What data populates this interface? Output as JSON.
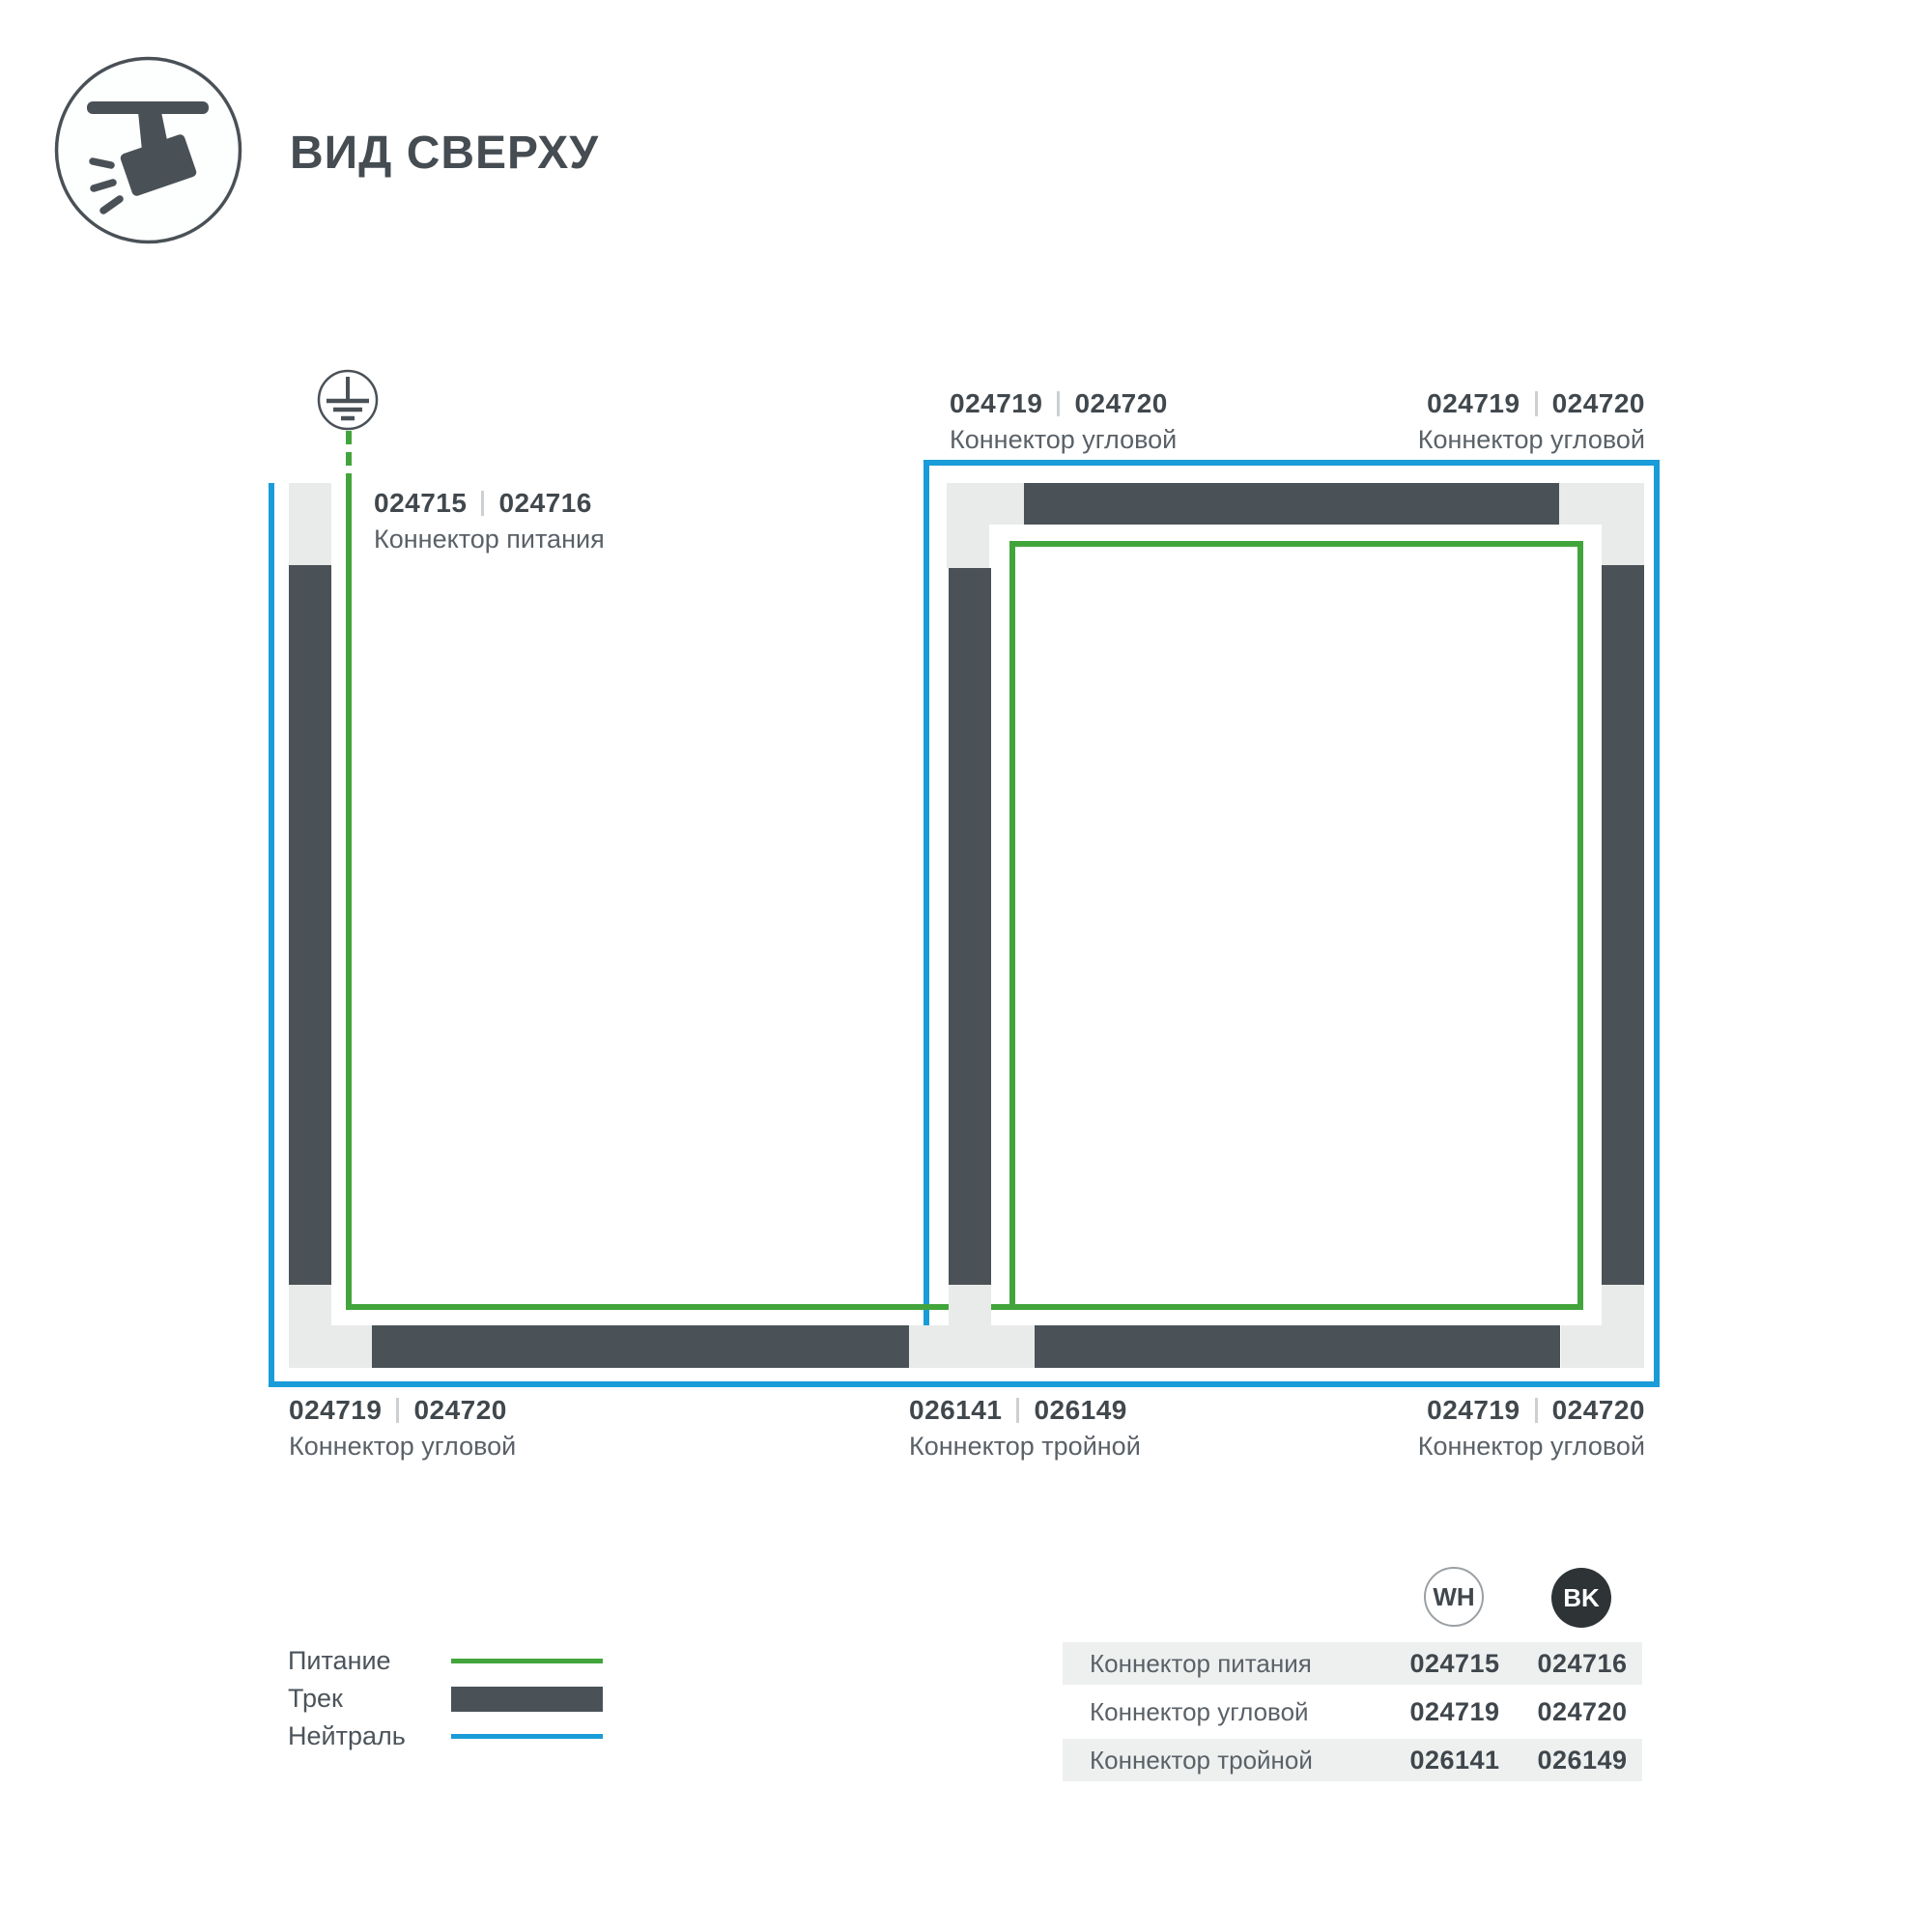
{
  "header": {
    "title": "ВИД СВЕРХУ",
    "icon": "track-spotlight-icon"
  },
  "diagram": {
    "ground_symbol": "earth-ground-icon",
    "labels": [
      {
        "id": "power-connector",
        "num_wh": "024715",
        "num_bk": "024716",
        "name": "Коннектор питания"
      },
      {
        "id": "corner-top-middle",
        "num_wh": "024719",
        "num_bk": "024720",
        "name": "Коннектор угловой"
      },
      {
        "id": "corner-top-right",
        "num_wh": "024719",
        "num_bk": "024720",
        "name": "Коннектор угловой"
      },
      {
        "id": "corner-bottom-left",
        "num_wh": "024719",
        "num_bk": "024720",
        "name": "Коннектор угловой"
      },
      {
        "id": "triple-bottom-middle",
        "num_wh": "026141",
        "num_bk": "026149",
        "name": "Коннектор тройной"
      },
      {
        "id": "corner-bottom-right",
        "num_wh": "024719",
        "num_bk": "024720",
        "name": "Коннектор угловой"
      }
    ]
  },
  "legend": {
    "items": [
      {
        "label": "Питание",
        "swatch": "green-line"
      },
      {
        "label": "Трек",
        "swatch": "dark-bar"
      },
      {
        "label": "Нейтраль",
        "swatch": "blue-line"
      }
    ]
  },
  "table": {
    "columns": [
      {
        "label": "WH"
      },
      {
        "label": "BK"
      }
    ],
    "rows": [
      {
        "name": "Коннектор питания",
        "wh": "024715",
        "bk": "024716"
      },
      {
        "name": "Коннектор угловой",
        "wh": "024719",
        "bk": "024720"
      },
      {
        "name": "Коннектор тройной",
        "wh": "026141",
        "bk": "026149"
      }
    ]
  },
  "colors": {
    "power_green": "#42a53c",
    "neutral_blue": "#199cd8",
    "track_dark": "#4a5257",
    "connector_gray": "#e9ebea",
    "text_dark": "#41484d",
    "text_medium": "#5a6167",
    "row_bg": "#eef0f0",
    "bk_circle": "#2e3336"
  }
}
